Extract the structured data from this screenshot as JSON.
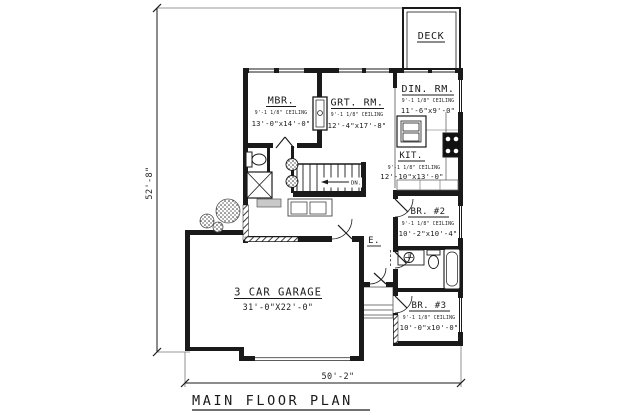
{
  "drawing": {
    "title": "MAIN FLOOR PLAN",
    "overall_depth": "52'-8\"",
    "overall_width": "50'-2\""
  },
  "rooms": {
    "deck": {
      "name": "DECK"
    },
    "mbr": {
      "name": "MBR.",
      "ceiling": "9'-1 1/8\" CEILING",
      "size": "13'-0\"x14'-0\""
    },
    "grt": {
      "name": "GRT. RM.",
      "ceiling": "9'-1 1/8\" CEILING",
      "size": "12'-4\"x17'-8\""
    },
    "din": {
      "name": "DIN. RM.",
      "ceiling": "9'-1 1/8\" CEILING",
      "size": "11'-6\"x9'-0\""
    },
    "kit": {
      "name": "KIT.",
      "ceiling": "9'-1 1/8\" CEILING",
      "size": "12'-10\"x13'-0\""
    },
    "br2": {
      "name": "BR. #2",
      "ceiling": "9'-1 1/8\" CEILING",
      "size": "10'-2\"x10'-4\""
    },
    "br3": {
      "name": "BR. #3",
      "ceiling": "9'-1 1/8\" CEILING",
      "size": "10'-0\"x10'-0\""
    },
    "garage": {
      "name": "3 CAR GARAGE",
      "size": "31'-0\"X22'-0\""
    },
    "entry": {
      "name": "E."
    }
  },
  "annotations": {
    "stair_direction": "DN."
  },
  "colors": {
    "ink": "#1a1a1a",
    "background": "#ffffff",
    "light_line": "#777777"
  }
}
